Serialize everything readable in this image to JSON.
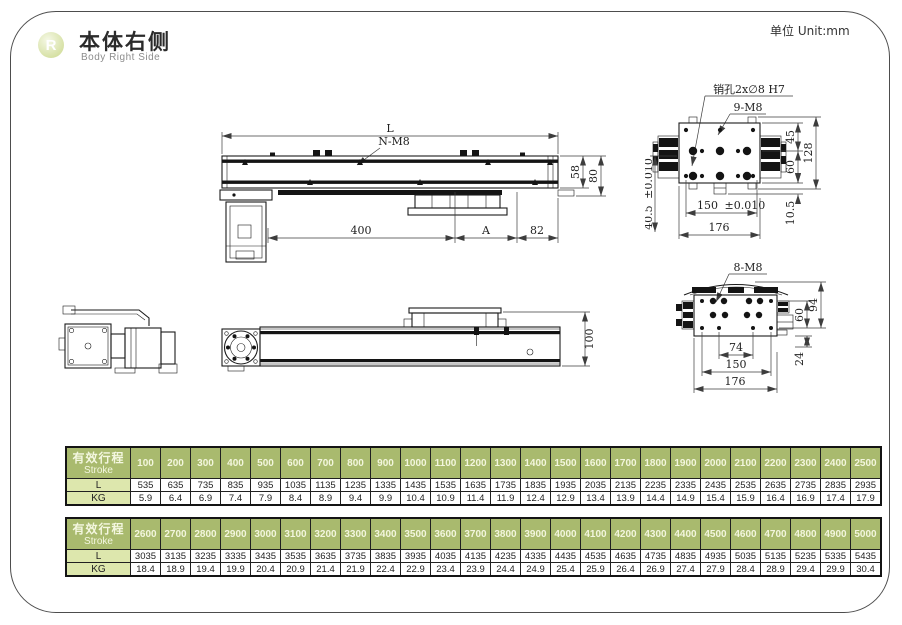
{
  "header": {
    "badge_letter": "R",
    "title_cn": "本体右侧",
    "title_en": "Body Right Side",
    "unit_label": "单位 Unit:mm"
  },
  "drawings": {
    "side_view": {
      "dim_length": "L",
      "thread_label": "N-M8",
      "dim_rail_height": "58",
      "dim_total_height": "80",
      "dim_motor_to_carriage": "400",
      "dim_a": "A",
      "dim_end": "82"
    },
    "carriage_top_view": {
      "pin_hole_label": "销孔2x∅8 H7",
      "thread_label": "9-M8",
      "dim_45": "45",
      "dim_60": "60",
      "dim_128": "128",
      "dim_10_5": "10.5",
      "dim_150": "150",
      "dim_150_tol": "±0.010",
      "dim_176": "176",
      "dim_40_5": "40.5",
      "dim_40_5_tol": "±0.010"
    },
    "rear_side_view": {
      "dim_100": "100"
    },
    "base_end_view": {
      "thread_label": "8-M8",
      "dim_60": "60",
      "dim_94": "94",
      "dim_24": "24",
      "dim_74": "74",
      "dim_150": "150",
      "dim_176": "176"
    }
  },
  "tables": [
    {
      "title_cn": "有效行程",
      "title_en": "Stroke",
      "strokes": [
        "100",
        "200",
        "300",
        "400",
        "500",
        "600",
        "700",
        "800",
        "900",
        "1000",
        "1100",
        "1200",
        "1300",
        "1400",
        "1500",
        "1600",
        "1700",
        "1800",
        "1900",
        "2000",
        "2100",
        "2200",
        "2300",
        "2400",
        "2500"
      ],
      "rows": [
        {
          "label": "L",
          "values": [
            "535",
            "635",
            "735",
            "835",
            "935",
            "1035",
            "1135",
            "1235",
            "1335",
            "1435",
            "1535",
            "1635",
            "1735",
            "1835",
            "1935",
            "2035",
            "2135",
            "2235",
            "2335",
            "2435",
            "2535",
            "2635",
            "2735",
            "2835",
            "2935"
          ]
        },
        {
          "label": "KG",
          "values": [
            "5.9",
            "6.4",
            "6.9",
            "7.4",
            "7.9",
            "8.4",
            "8.9",
            "9.4",
            "9.9",
            "10.4",
            "10.9",
            "11.4",
            "11.9",
            "12.4",
            "12.9",
            "13.4",
            "13.9",
            "14.4",
            "14.9",
            "15.4",
            "15.9",
            "16.4",
            "16.9",
            "17.4",
            "17.9"
          ]
        }
      ]
    },
    {
      "title_cn": "有效行程",
      "title_en": "Stroke",
      "strokes": [
        "2600",
        "2700",
        "2800",
        "2900",
        "3000",
        "3100",
        "3200",
        "3300",
        "3400",
        "3500",
        "3600",
        "3700",
        "3800",
        "3900",
        "4000",
        "4100",
        "4200",
        "4300",
        "4400",
        "4500",
        "4600",
        "4700",
        "4800",
        "4900",
        "5000"
      ],
      "rows": [
        {
          "label": "L",
          "values": [
            "3035",
            "3135",
            "3235",
            "3335",
            "3435",
            "3535",
            "3635",
            "3735",
            "3835",
            "3935",
            "4035",
            "4135",
            "4235",
            "4335",
            "4435",
            "4535",
            "4635",
            "4735",
            "4835",
            "4935",
            "5035",
            "5135",
            "5235",
            "5335",
            "5435"
          ]
        },
        {
          "label": "KG",
          "values": [
            "18.4",
            "18.9",
            "19.4",
            "19.9",
            "20.4",
            "20.9",
            "21.4",
            "21.9",
            "22.4",
            "22.9",
            "23.4",
            "23.9",
            "24.4",
            "24.9",
            "25.4",
            "25.9",
            "26.4",
            "26.9",
            "27.4",
            "27.9",
            "28.4",
            "28.9",
            "29.4",
            "29.9",
            "30.4"
          ]
        }
      ]
    }
  ]
}
